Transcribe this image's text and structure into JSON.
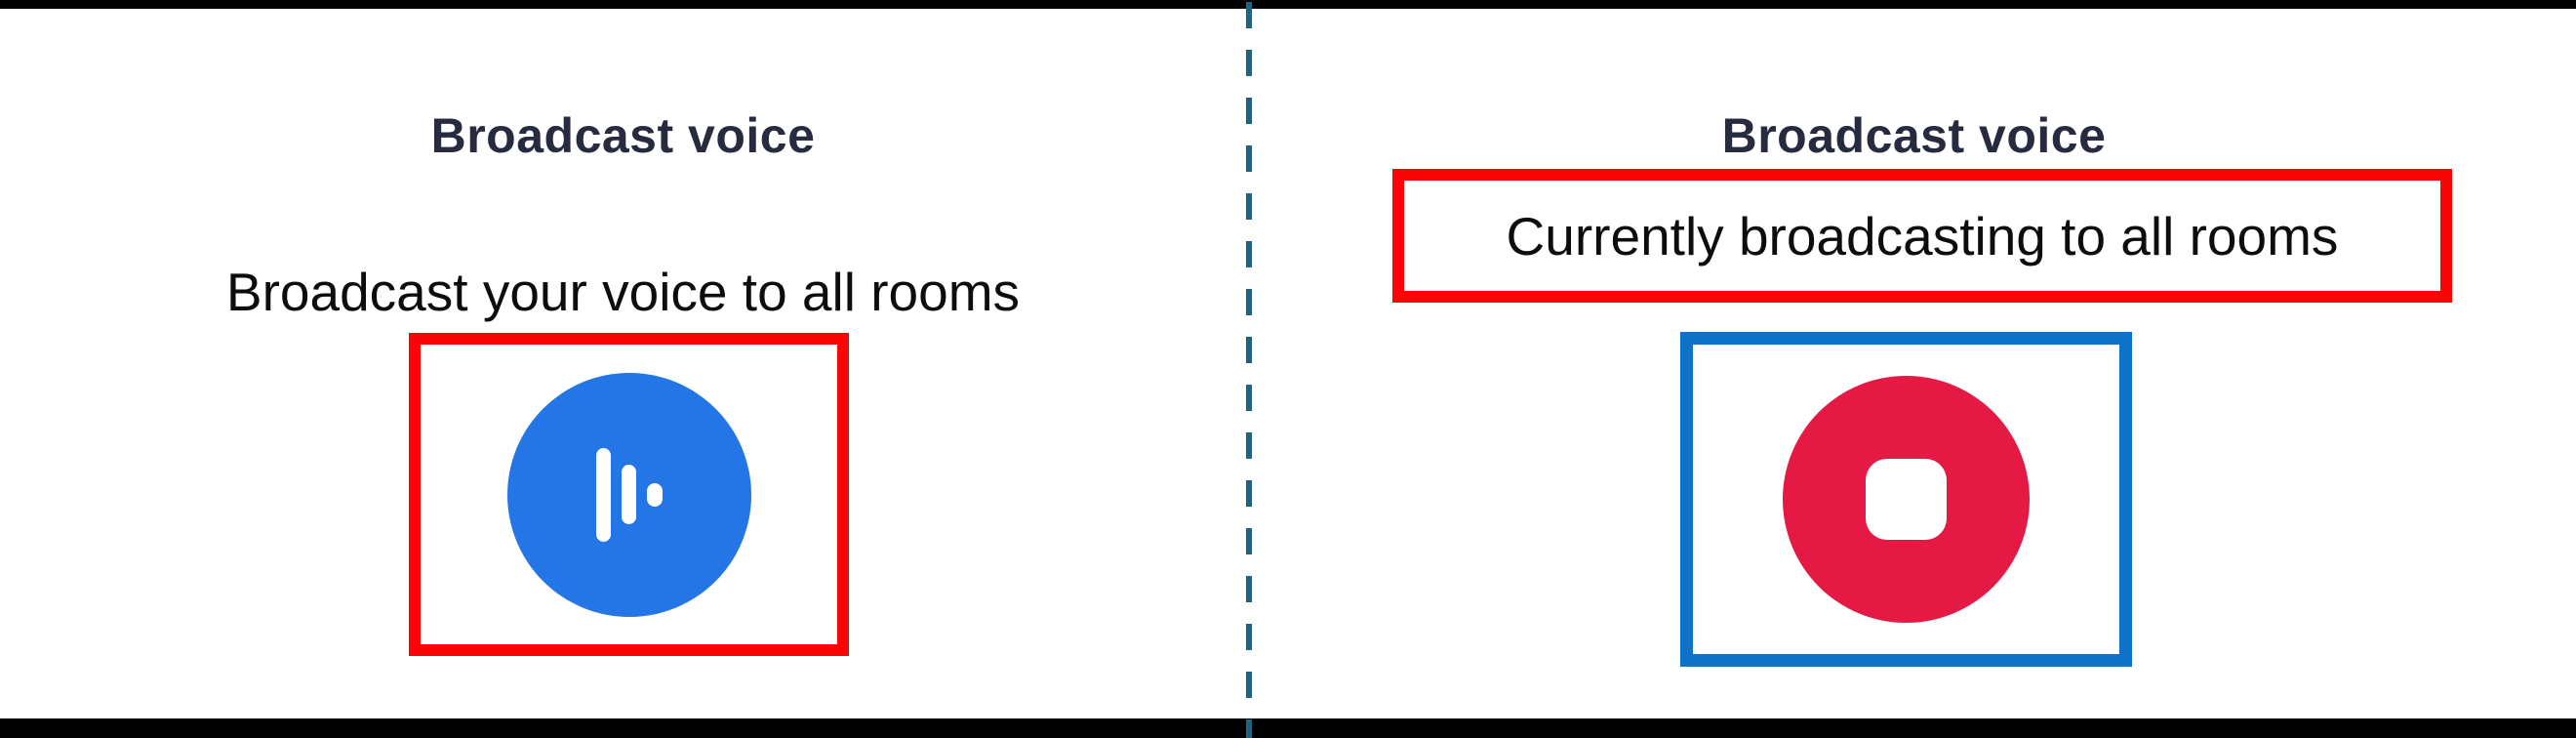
{
  "colors": {
    "title_text": "#262b40",
    "body_text": "#0d0d0d",
    "primary_blue": "#2475e5",
    "stop_crimson": "#e51a44",
    "annotation_red": "#fa0505",
    "annotation_blue": "#0d72c8",
    "divider_teal": "#1f6380",
    "frame_black": "#000000"
  },
  "left_panel": {
    "title": "Broadcast voice",
    "subtitle": "Broadcast your voice to all rooms",
    "button_icon": "voice-wave-icon"
  },
  "right_panel": {
    "title": "Broadcast voice",
    "subtitle": "Currently broadcasting to all rooms",
    "button_icon": "stop-icon"
  }
}
